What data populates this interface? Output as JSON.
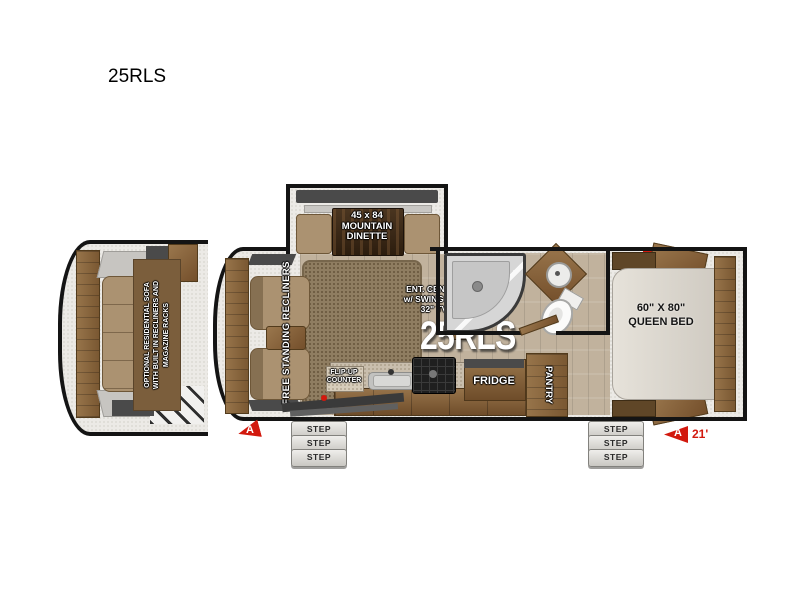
{
  "title": "25RLS",
  "watermark": "25RLS",
  "colors": {
    "accent_red": "#d2190e",
    "wall_black": "#141414",
    "cabinet_wood": "#8a6742"
  },
  "inset": {
    "sofa_label": "OPTIONAL RESIDENTIAL SOFA\nWITH BUILT IN RECLINERS AND\nMAGAZINE RACKS"
  },
  "dinette": {
    "label": "45 x 84\nMOUNTAIN\nDINETTE"
  },
  "living": {
    "recliners_label": "FREE STANDING RECLINERS",
    "ent_center_label": "ENT. CENTER\nw/ SWING OUT\n32\" TV"
  },
  "bedroom": {
    "bed_label": "60\" X 80\"\nQUEEN BED"
  },
  "kitchen": {
    "flip_up_label": "FLIP-UP\nCOUNTER",
    "fridge_label": "FRIDGE",
    "pantry_label": "PANTRY"
  },
  "steps": {
    "label": "STEP"
  },
  "markers": {
    "door": "A",
    "rear": "A",
    "length": "21'"
  },
  "icons": {
    "tv": "TV"
  }
}
